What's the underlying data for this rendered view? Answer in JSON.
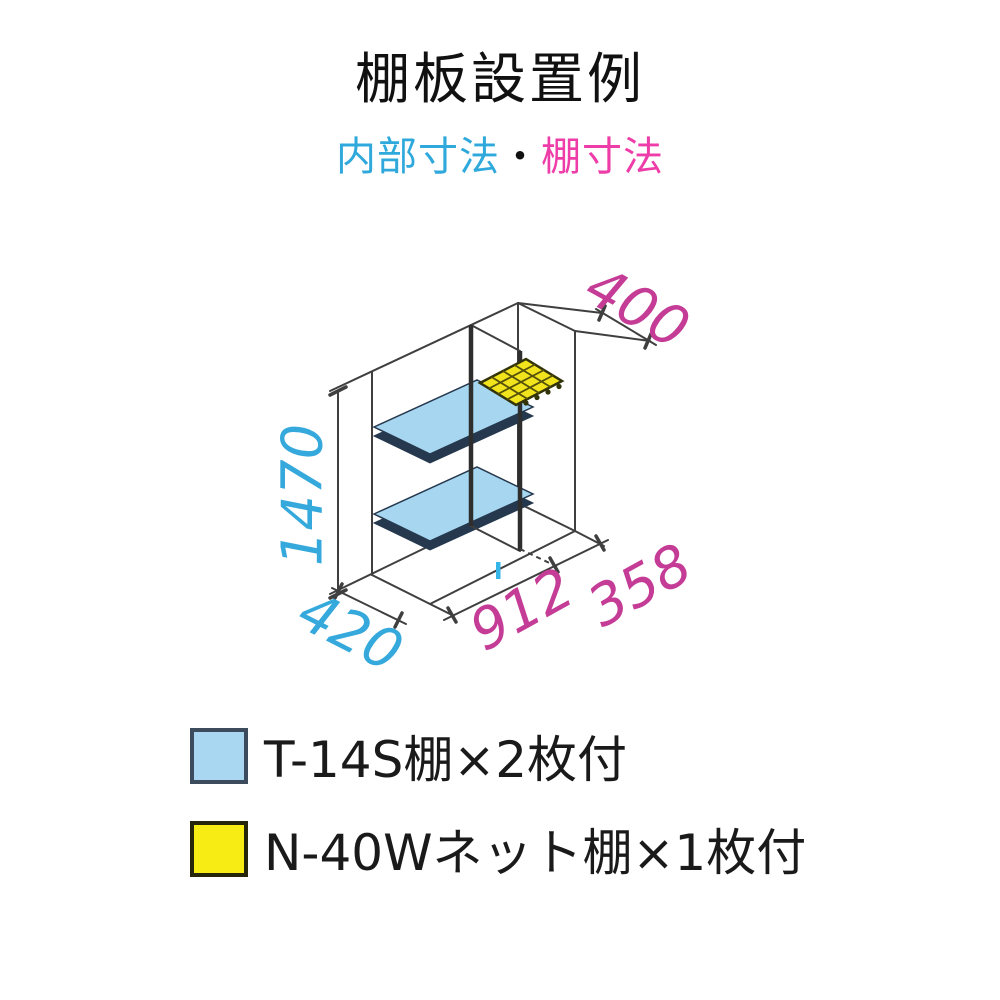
{
  "title": "棚板設置例",
  "subtitle": {
    "inner": "内部寸法",
    "dot": "・",
    "shelf": "棚寸法",
    "inner_color": "#2fa9dc",
    "shelf_color": "#ee3da8"
  },
  "diagram": {
    "dimensions": {
      "height": "1470",
      "depth": "420",
      "width_left": "912",
      "width_right": "358",
      "net_depth": "400"
    },
    "colors": {
      "inner_dim_text": "#35a9dc",
      "shelf_dim_text": "#c43c96",
      "shelf_fill": "#a7d7f0",
      "net_fill": "#f2e41c",
      "divider_marker": "#35b5e8"
    }
  },
  "legend": {
    "items": [
      {
        "label": "T-14S棚×2枚付",
        "swatch_style": "background:#a9d6f0;border:4px solid #3d4c5c"
      },
      {
        "label": "N-40Wネット棚×1枚付",
        "swatch_style": "background:#f7ec13;border:4px solid #26260a"
      }
    ]
  }
}
